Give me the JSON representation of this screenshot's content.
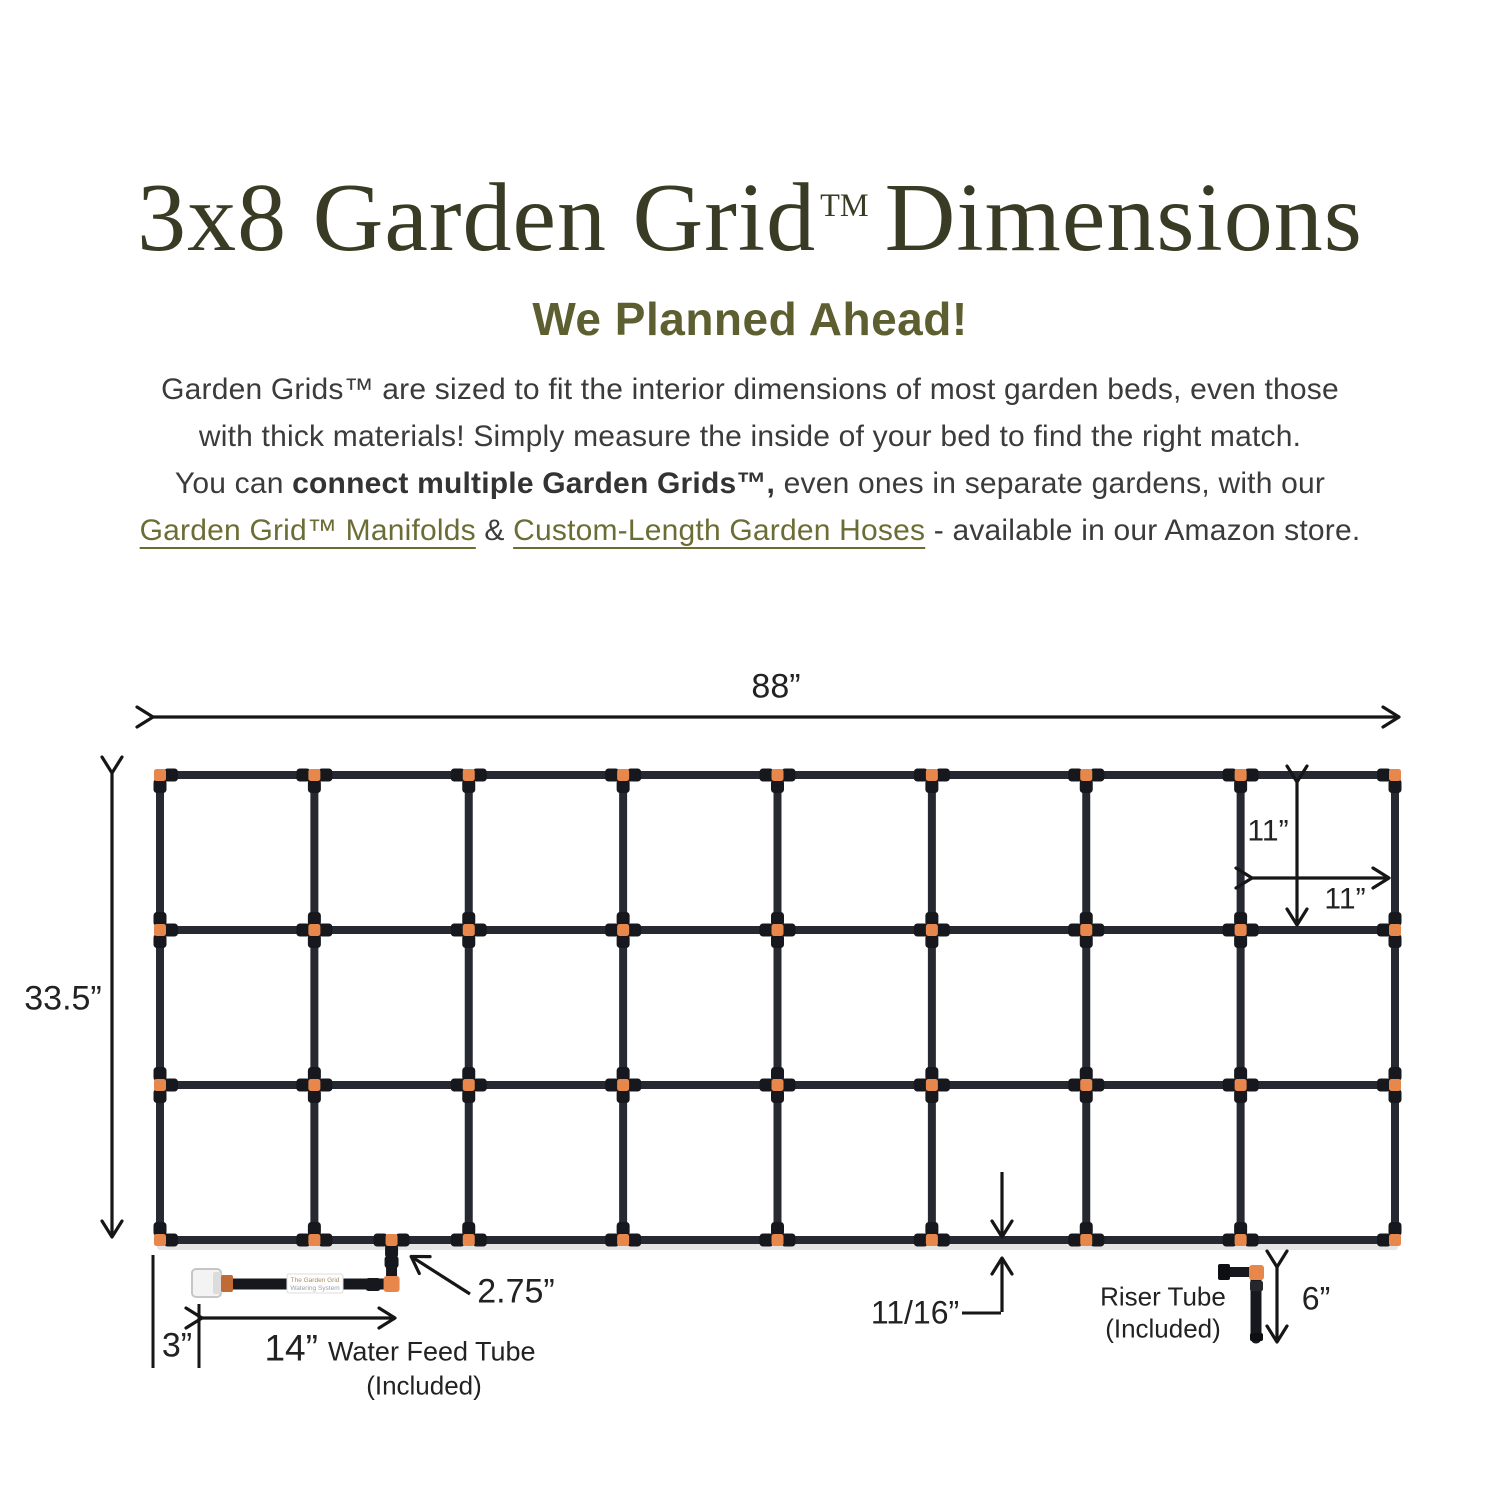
{
  "title": {
    "part1": "3x8 Garden Grid",
    "tm": "TM",
    "part2": "Dimensions"
  },
  "subtitle": "We Planned Ahead!",
  "paragraph": {
    "line1": "Garden Grids™ are sized to fit the interior dimensions of most garden beds, even those",
    "line2": "with thick materials! Simply measure the inside of your bed to find the right match.",
    "line3_pre": "You can ",
    "line3_bold": "connect multiple Garden Grids™,",
    "line3_post": " even ones in separate gardens, with our",
    "line4_link1": "Garden Grid™ Manifolds",
    "line4_amp": " & ",
    "line4_link2": "Custom-Length Garden Hoses",
    "line4_post": " - available in our Amazon store."
  },
  "diagram": {
    "grid": {
      "rows": 3,
      "cols": 8
    },
    "labels": {
      "width": "88”",
      "height": "33.5”",
      "cell_h": "11”",
      "cell_w": "11”",
      "elbow": "2.75”",
      "cap": "3”",
      "feed_len": "14”",
      "feed_name": "Water Feed Tube",
      "feed_included": "(Included)",
      "pipe_dia": "11/16”",
      "riser_name": "Riser Tube",
      "riser_included": "(Included)",
      "riser_len": "6”"
    },
    "tube_label": {
      "line1": "The Garden Grid",
      "line2": "Watering System"
    },
    "colors": {
      "pipe": "#262932",
      "fitting": "#16181d",
      "connector": "#e8874b",
      "connector_dark": "#c06a35",
      "arrow": "#161616",
      "cap_white": "#f3f3f3",
      "cap_border": "#c6c6c6"
    }
  }
}
